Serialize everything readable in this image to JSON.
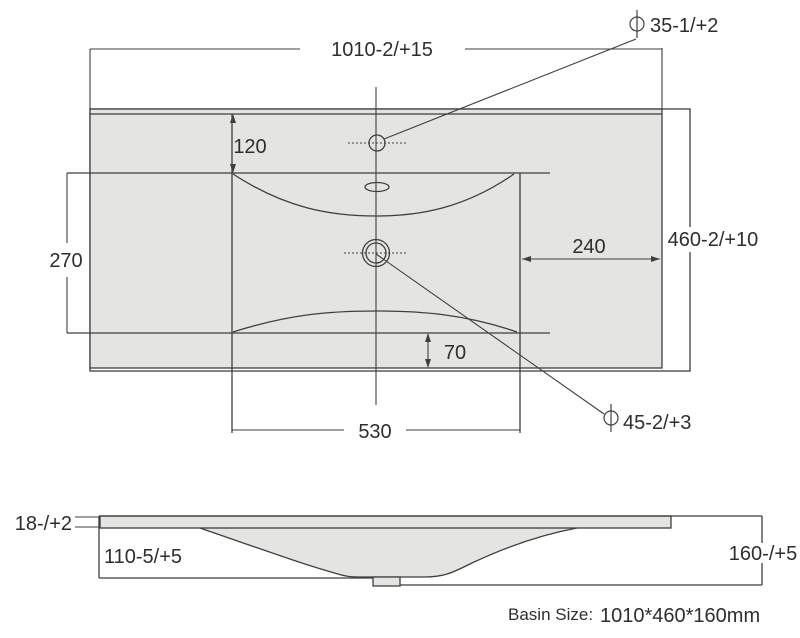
{
  "drawing": {
    "colors": {
      "surface_fill": "#e4e4e2",
      "line": "#3f3f3f",
      "text": "#2e2e2e",
      "background": "#ffffff"
    },
    "top_view": {
      "overall_width": "1010-2/+15",
      "overall_depth": "460-2/+10",
      "faucet_setback": "120",
      "bowl_front_span": "270",
      "right_inset": "240",
      "bowl_width": "530",
      "rear_inset": "70",
      "faucet_hole": {
        "symbol": "Φ",
        "text": "35-1/+2"
      },
      "drain_hole": {
        "symbol": "Φ",
        "text": "45-2/+3"
      }
    },
    "side_view": {
      "top_thickness": "18-/+2",
      "bowl_depth": "110-5/+5",
      "overall_height": "160-/+5"
    },
    "caption": {
      "label": "Basin Size:",
      "value": "1010*460*160mm"
    }
  }
}
